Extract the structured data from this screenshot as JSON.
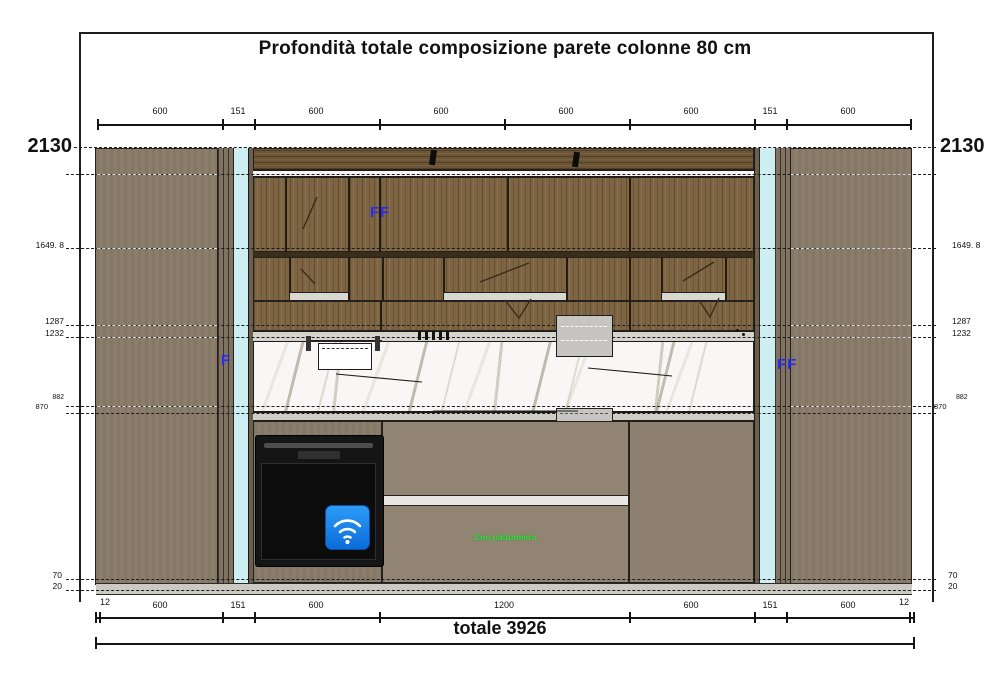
{
  "title": "Profondità totale composizione parete colonne 80 cm",
  "totals": {
    "label": "totale 3926"
  },
  "heights": {
    "overall": "2130"
  },
  "dims_top": [
    "600",
    "151",
    "600",
    "600",
    "600",
    "600",
    "151",
    "600"
  ],
  "dims_bottom": [
    "12",
    "600",
    "151",
    "600",
    "1200",
    "600",
    "151",
    "600",
    "12"
  ],
  "refs": {
    "r1649": "1649. 8",
    "r1287": "1287",
    "r1232": "1232",
    "r882": "882",
    "r870": "870",
    "r70": "70",
    "r20": "20"
  },
  "annotations": {
    "ff": "FF",
    "f": "F",
    "bin_note": "Con pattumiera"
  },
  "colors": {
    "accent_blue": "#2b2bf0",
    "note_green": "#2ee83c",
    "cyan_panel": "#cdeef2",
    "wood": "#7d6443",
    "taupe": "#8b7d6b",
    "marble": "#f8f7f5",
    "oven_black": "#141414",
    "wifi_blue": "#1f7fe8"
  }
}
